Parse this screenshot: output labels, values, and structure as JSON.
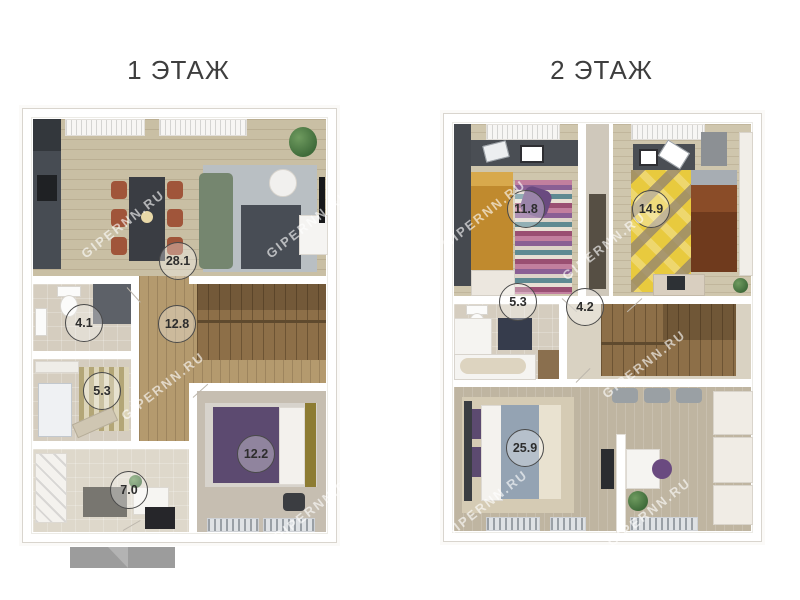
{
  "page": {
    "background": "#ffffff",
    "watermark": "GIPERNN.RU"
  },
  "floors": [
    {
      "title": "1 ЭТАЖ",
      "rooms": [
        {
          "name": "kitchen-living-room",
          "area": "28.1"
        },
        {
          "name": "bathroom",
          "area": "4.1"
        },
        {
          "name": "hall-with-stairs",
          "area": "12.8"
        },
        {
          "name": "utility-room",
          "area": "5.3"
        },
        {
          "name": "entry-hall",
          "area": "7.0"
        },
        {
          "name": "bedroom",
          "area": "12.2"
        }
      ]
    },
    {
      "title": "2 ЭТАЖ",
      "rooms": [
        {
          "name": "bedroom-left",
          "area": "11.8"
        },
        {
          "name": "bedroom-right",
          "area": "14.9"
        },
        {
          "name": "bathroom",
          "area": "5.3"
        },
        {
          "name": "landing-with-stairs",
          "area": "4.2"
        },
        {
          "name": "master-bedroom-study",
          "area": "25.9"
        }
      ]
    }
  ],
  "colors": {
    "title_text": "#3e3e3e",
    "bed_purple": "#5c4a70",
    "bed_mustard": "#c08a2e",
    "bed_brown": "#8a4c28",
    "duvet_blue_gray": "#94a3b3",
    "rug_yellow": "#e8ca3e",
    "sofa_green": "#75866f",
    "dining_chairs_rust": "#a0553a",
    "porch_gray": "#9c9c9c"
  }
}
